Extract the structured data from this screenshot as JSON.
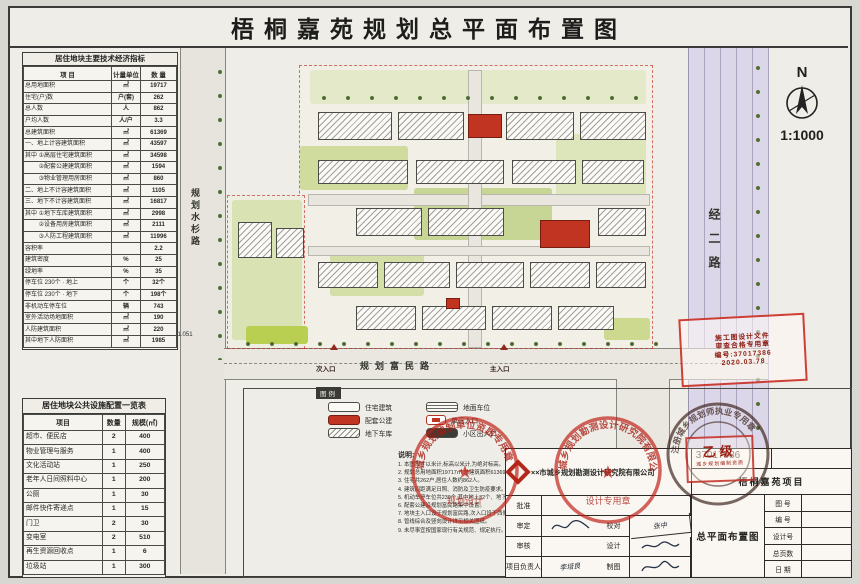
{
  "title": "梧桐嘉苑规划总平面布置图",
  "north": {
    "n": "N",
    "scale": "1:1000"
  },
  "roads": {
    "left": "规划水杉路",
    "right": "经二路",
    "bottom": "规划富民路",
    "entry_side": "次入口",
    "entry_main": "主入口"
  },
  "coords": {
    "x_line": "X=4502981.051",
    "elev": "34.00"
  },
  "indicators_table": {
    "title": "居住地块主要技术经济指标",
    "headers": [
      "项  目",
      "计量单位",
      "数  量"
    ],
    "rows": [
      [
        "总用地面积",
        "㎡",
        "19717"
      ],
      [
        "住宅(户)数",
        "户(套)",
        "262"
      ],
      [
        "总人数",
        "人",
        "862"
      ],
      [
        "户均人数",
        "人/户",
        "3.3"
      ],
      [
        "总建筑面积",
        "㎡",
        "61369"
      ],
      [
        "一、地上计容建筑面积",
        "㎡",
        "43597"
      ],
      [
        "其中 ①高层住宅建筑面积",
        "㎡",
        "34598"
      ],
      [
        "　　 ②配套公建建筑面积",
        "㎡",
        "1594"
      ],
      [
        "　　 ③物业管理用房面积",
        "㎡",
        "860"
      ],
      [
        "二、地上不计容建筑面积",
        "㎡",
        "1105"
      ],
      [
        "三、地下不计容建筑面积",
        "㎡",
        "16817"
      ],
      [
        "其中 ①地下车库建筑面积",
        "㎡",
        "2998"
      ],
      [
        "　　 ②设备用房建筑面积",
        "㎡",
        "2111"
      ],
      [
        "　　 ③人防工程建筑面积",
        "㎡",
        "11996"
      ],
      [
        "容积率",
        "",
        "2.2"
      ],
      [
        "建筑密度",
        "%",
        "25"
      ],
      [
        "绿地率",
        "%",
        "35"
      ],
      [
        "停车位 230个 · 地上",
        "个",
        "32个"
      ],
      [
        "停车位 230个 · 地下",
        "个",
        "198个"
      ],
      [
        "非机动车停车位",
        "辆",
        "743"
      ],
      [
        "室外活动场地面积",
        "㎡",
        "190"
      ],
      [
        "人防建筑面积",
        "㎡",
        "220"
      ],
      [
        "其中地下人防面积",
        "㎡",
        "1985"
      ]
    ]
  },
  "facilities_table": {
    "title": "居住地块公共设施配置一览表",
    "headers": [
      "项目",
      "数量",
      "规模(㎡)"
    ],
    "rows": [
      [
        "超市、便民店",
        "2",
        "400"
      ],
      [
        "物业管理与服务",
        "1",
        "400"
      ],
      [
        "文化活动站",
        "1",
        "250"
      ],
      [
        "老年人日间照料中心",
        "1",
        "200"
      ],
      [
        "公厕",
        "1",
        "30"
      ],
      [
        "邮件快件寄递点",
        "1",
        "15"
      ],
      [
        "门卫",
        "2",
        "30"
      ],
      [
        "变电室",
        "2",
        "510"
      ],
      [
        "再生资源回收点",
        "1",
        "6"
      ],
      [
        "垃圾站",
        "1",
        "300"
      ]
    ]
  },
  "legend": {
    "title": "图例",
    "items": [
      {
        "label": "住宅建筑"
      },
      {
        "label": "地面车位"
      },
      {
        "label": "配套公建"
      },
      {
        "label": "单元入口"
      },
      {
        "label": "地下车库"
      },
      {
        "label": "小区出入口"
      }
    ]
  },
  "notes": {
    "title": "说明:",
    "lines": [
      "1. 本图尺寸以米计,标高以米计,为绝对标高。",
      "2. 规划总用地面积19717㎡,总建筑面积61369㎡。",
      "3. 住宅共262户,居住人数约862人。",
      "4. 建筑间距满足日照、消防及卫生防疫要求。",
      "5. 机动车停车位共230个,其中地上32个、地下198个。",
      "6. 配套公建沿规划富民路集中设置。",
      "7. 地块主入口设于规划富民路,次入口设于西侧。",
      "8. 管线综合及竖向设计详见相关图纸。",
      "9. 未尽事宜按国家现行有关规范、规定执行。"
    ]
  },
  "stamps": {
    "rect_red_lines": [
      "施工图设计文件",
      "审查合格专用章",
      "编号:37017386",
      "2020.03.78"
    ],
    "round_company_arc": "城乡规划勘测设计研究院有限公司",
    "round_company_sub": "设计专用章",
    "round_center_arc": "城乡规划编制单位资质专用章",
    "round_center_sub": "规划设计",
    "round_dark_arc": "注册城乡规划师执业专用章",
    "round_dark_num": "37017386",
    "square_red_big": "乙级",
    "square_red_small": "城乡规划编制资质"
  },
  "titleblock": {
    "company": "××市城乡规划勘测设计研究院有限公司",
    "project": "梧桐嘉苑项目",
    "drawing": "总平面布置图",
    "labels": {
      "approve": "批准",
      "verify": "审定",
      "proof": "校对",
      "check": "审核",
      "design": "设计",
      "lead": "项目负责人",
      "draft": "制图"
    },
    "signatures": {
      "proof": "张中",
      "lead": "李培良"
    },
    "meta": [
      {
        "label": "图 号",
        "value": ""
      },
      {
        "label": "编 号",
        "value": ""
      },
      {
        "label": "设计号",
        "value": ""
      },
      {
        "label": "总页数",
        "value": ""
      },
      {
        "label": "日 期",
        "value": ""
      }
    ]
  }
}
